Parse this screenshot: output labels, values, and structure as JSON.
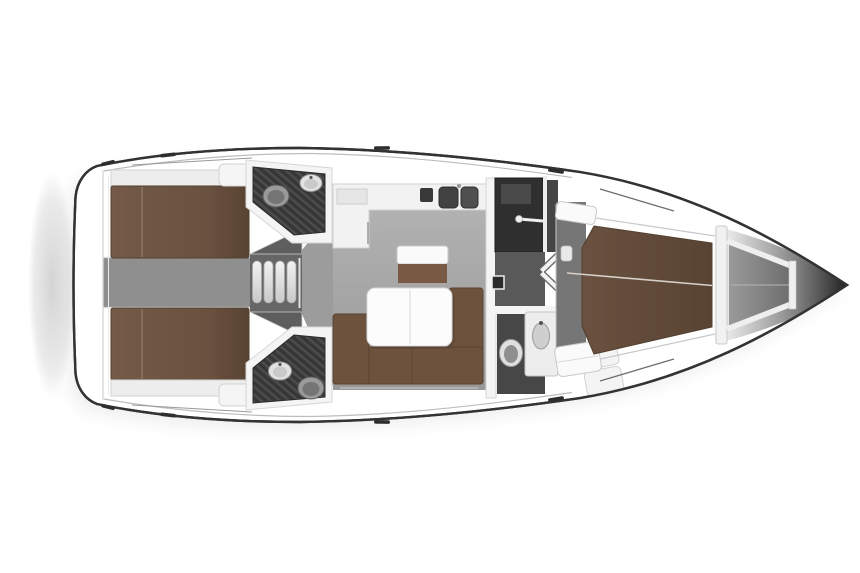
{
  "meta": {
    "document": "sailing-yacht-interior-floor-plan",
    "view": "top-down",
    "bow_direction": "right"
  },
  "regions": [
    {
      "id": "swim-platform",
      "label": "stern swim platform shadow"
    },
    {
      "id": "aft-cabin-port",
      "label": "aft double-berth cabin (top)"
    },
    {
      "id": "aft-cabin-starboard",
      "label": "aft double-berth cabin (bottom)"
    },
    {
      "id": "aft-head-port",
      "label": "aft bathroom with toilet and washbasin (top)"
    },
    {
      "id": "aft-head-starboard",
      "label": "aft bathroom with toilet and washbasin (bottom)"
    },
    {
      "id": "companionway",
      "label": "entry steps between aft cabins"
    },
    {
      "id": "salon",
      "label": "main salon with L-sofa and table"
    },
    {
      "id": "galley",
      "label": "galley counter with double sink"
    },
    {
      "id": "mid-corridor",
      "label": "passage with folding double door and wardrobe"
    },
    {
      "id": "forward-head",
      "label": "forward bathroom with toilet and vanity basin"
    },
    {
      "id": "forward-cabin",
      "label": "forward V-berth cabin"
    },
    {
      "id": "anchor-locker",
      "label": "bow anchor locker"
    }
  ],
  "colors": {
    "page_bg": "#ffffff",
    "hull_outline": "#333333",
    "hull_fill": "#ffffff",
    "toe_rail": "#bdbdbd",
    "deck_line": "#9a9a9a",
    "bow_line": "#6e6e6e",
    "cleat": "#2e2e2e",
    "shadow": "#9e9e9e",
    "stern_shadow": "#b0b0b0",
    "wall_white": "#f4f4f4",
    "wall_edge": "#d6d6d6",
    "shelf": "#ededed",
    "shelf_edge": "#d2d2d2",
    "nightstand": "#f5f5f5",
    "bed_light": "#745a47",
    "bed_brown": "#6a5140",
    "bed_dark": "#584333",
    "bed_edge": "#53402f",
    "bed_seam": "#c9bcae",
    "corridor": "#8f8f8f",
    "corridor_line": "#dadada",
    "steps_bg": "#666666",
    "wedge": "#5e5e5e",
    "wedge_edge": "#cfcfcf",
    "step_light": "#f2f2f2",
    "step_dark": "#c9c9c9",
    "step_edge": "#a8a8a8",
    "threshold": "#e0e0e0",
    "passage": "#9c9c9c",
    "salon_light": "#b3b3b3",
    "salon_dark": "#989898",
    "head_floor": "#3d3d3d",
    "hatch_line": "#565656",
    "toilet_body": "#9a9a9a",
    "toilet_inner": "#757575",
    "fixture_edge": "#5e5e5e",
    "sink_white": "#e2e2e2",
    "sink_inner": "#cacaca",
    "sink_edge": "#979797",
    "faucet": "#555555",
    "counter": "#f2f2f2",
    "counter_edge": "#d0d0d0",
    "galley_sink_l": "#424242",
    "galley_sink_r": "#4f4f4f",
    "stove": "#383838",
    "cooktop": "#e6e6e6",
    "seat_top": "#fafafa",
    "seat_edge": "#c9c9c9",
    "seat_brown": "#7a5a45",
    "table": "#fcfcfc",
    "table_edge": "#d8d8d8",
    "table_seam": "#e4e4e4",
    "table_shadow": "#000000",
    "sofa": "#6d523e",
    "sofa_edge": "#5a4231",
    "floor_strip": "#c2c2c2",
    "wardrobe_a": "#2f2f2f",
    "wardrobe_b": "#454545",
    "wardrobe_panel": "#4a4a4a",
    "divider": "#ededed",
    "rod": "#f0f0f0",
    "mid_corridor": "#595959",
    "step_box": "#2a2a2a",
    "step_box_edge": "#ececec",
    "door_shadow": "#6a6a6a",
    "door_white": "#f3f3f3",
    "fore_floor": "#767676",
    "fore_step": "#e9e9e9",
    "fore_head_floor": "#474747",
    "porcelain": "#e0e0e0",
    "porcelain_inner": "#8f8f8f",
    "basin": "#cfcfcf",
    "basin_edge": "#9e9e9e",
    "locker_light": "#9a9a9a",
    "locker_dark": "#6e6e6e",
    "strut": "#efefef",
    "strut_edge": "#c9c9c9",
    "bow_mid": "#8f8f8f",
    "bow_dark": "#1f1f1f",
    "bulkhead": "#f1f1f1",
    "bulkhead_edge": "#cbcbcb",
    "seam_line": "#d6d0c8",
    "center_line": "#b4b4b4"
  }
}
